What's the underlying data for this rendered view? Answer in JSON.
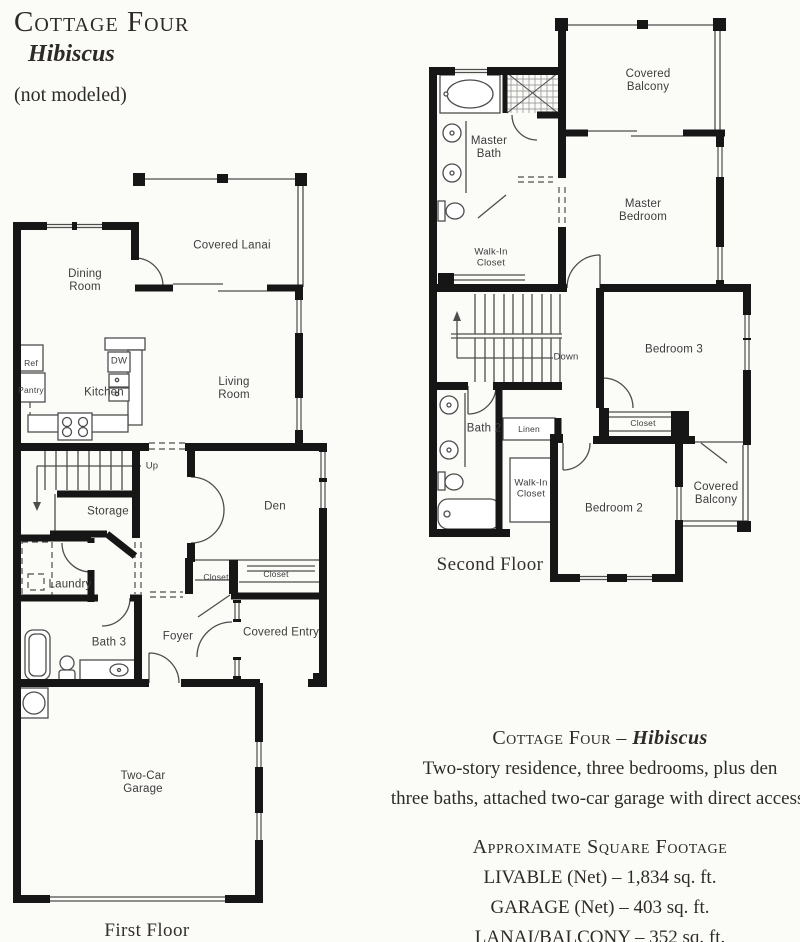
{
  "header": {
    "title": "Cottage Four",
    "subtitle": "Hibiscus",
    "note": "(not modeled)"
  },
  "first_floor": {
    "caption": "First Floor",
    "labels": {
      "covered_lanai": "Covered Lanai",
      "dining_room": "Dining Room",
      "ref": "Ref",
      "pantry": "Pantry",
      "kitchen": "Kitchen",
      "dw": "DW",
      "living_room": "Living Room",
      "up": "Up",
      "storage": "Storage",
      "laundry": "Laundry",
      "den": "Den",
      "closet_left": "Closet",
      "closet_right": "Closet",
      "bath_3": "Bath 3",
      "foyer": "Foyer",
      "covered_entry": "Covered Entry",
      "garage": "Two-Car Garage"
    }
  },
  "second_floor": {
    "caption": "Second Floor",
    "labels": {
      "covered_balcony_upper": "Covered Balcony",
      "master_bath": "Master Bath",
      "master_bedroom": "Master Bedroom",
      "walk_in_closet_master": "Walk-In Closet",
      "down": "Down",
      "bedroom_3": "Bedroom 3",
      "bath_2": "Bath 2",
      "linen": "Linen",
      "closet": "Closet",
      "walk_in_closet_2": "Walk-In Closet",
      "bedroom_2": "Bedroom 2",
      "covered_balcony_lower": "Covered Balcony"
    }
  },
  "description": {
    "title_prefix": "Cottage Four – ",
    "model_name": "Hibiscus",
    "line1": "Two-story residence, three bedrooms, plus den",
    "line2": "three baths, attached two-car garage with direct access."
  },
  "square_footage": {
    "heading": "Approximate Square Footage",
    "items": [
      "LIVABLE (Net) – 1,834 sq. ft.",
      "GARAGE (Net) – 403 sq. ft.",
      "LANAI/BALCONY – 352 sq. ft."
    ]
  },
  "colors": {
    "wall": "#161616",
    "thin_line": "#4d4d4d",
    "label_text": "#3c3c3c",
    "serif_text": "#2e2b27",
    "background": "#fbfbf8"
  }
}
